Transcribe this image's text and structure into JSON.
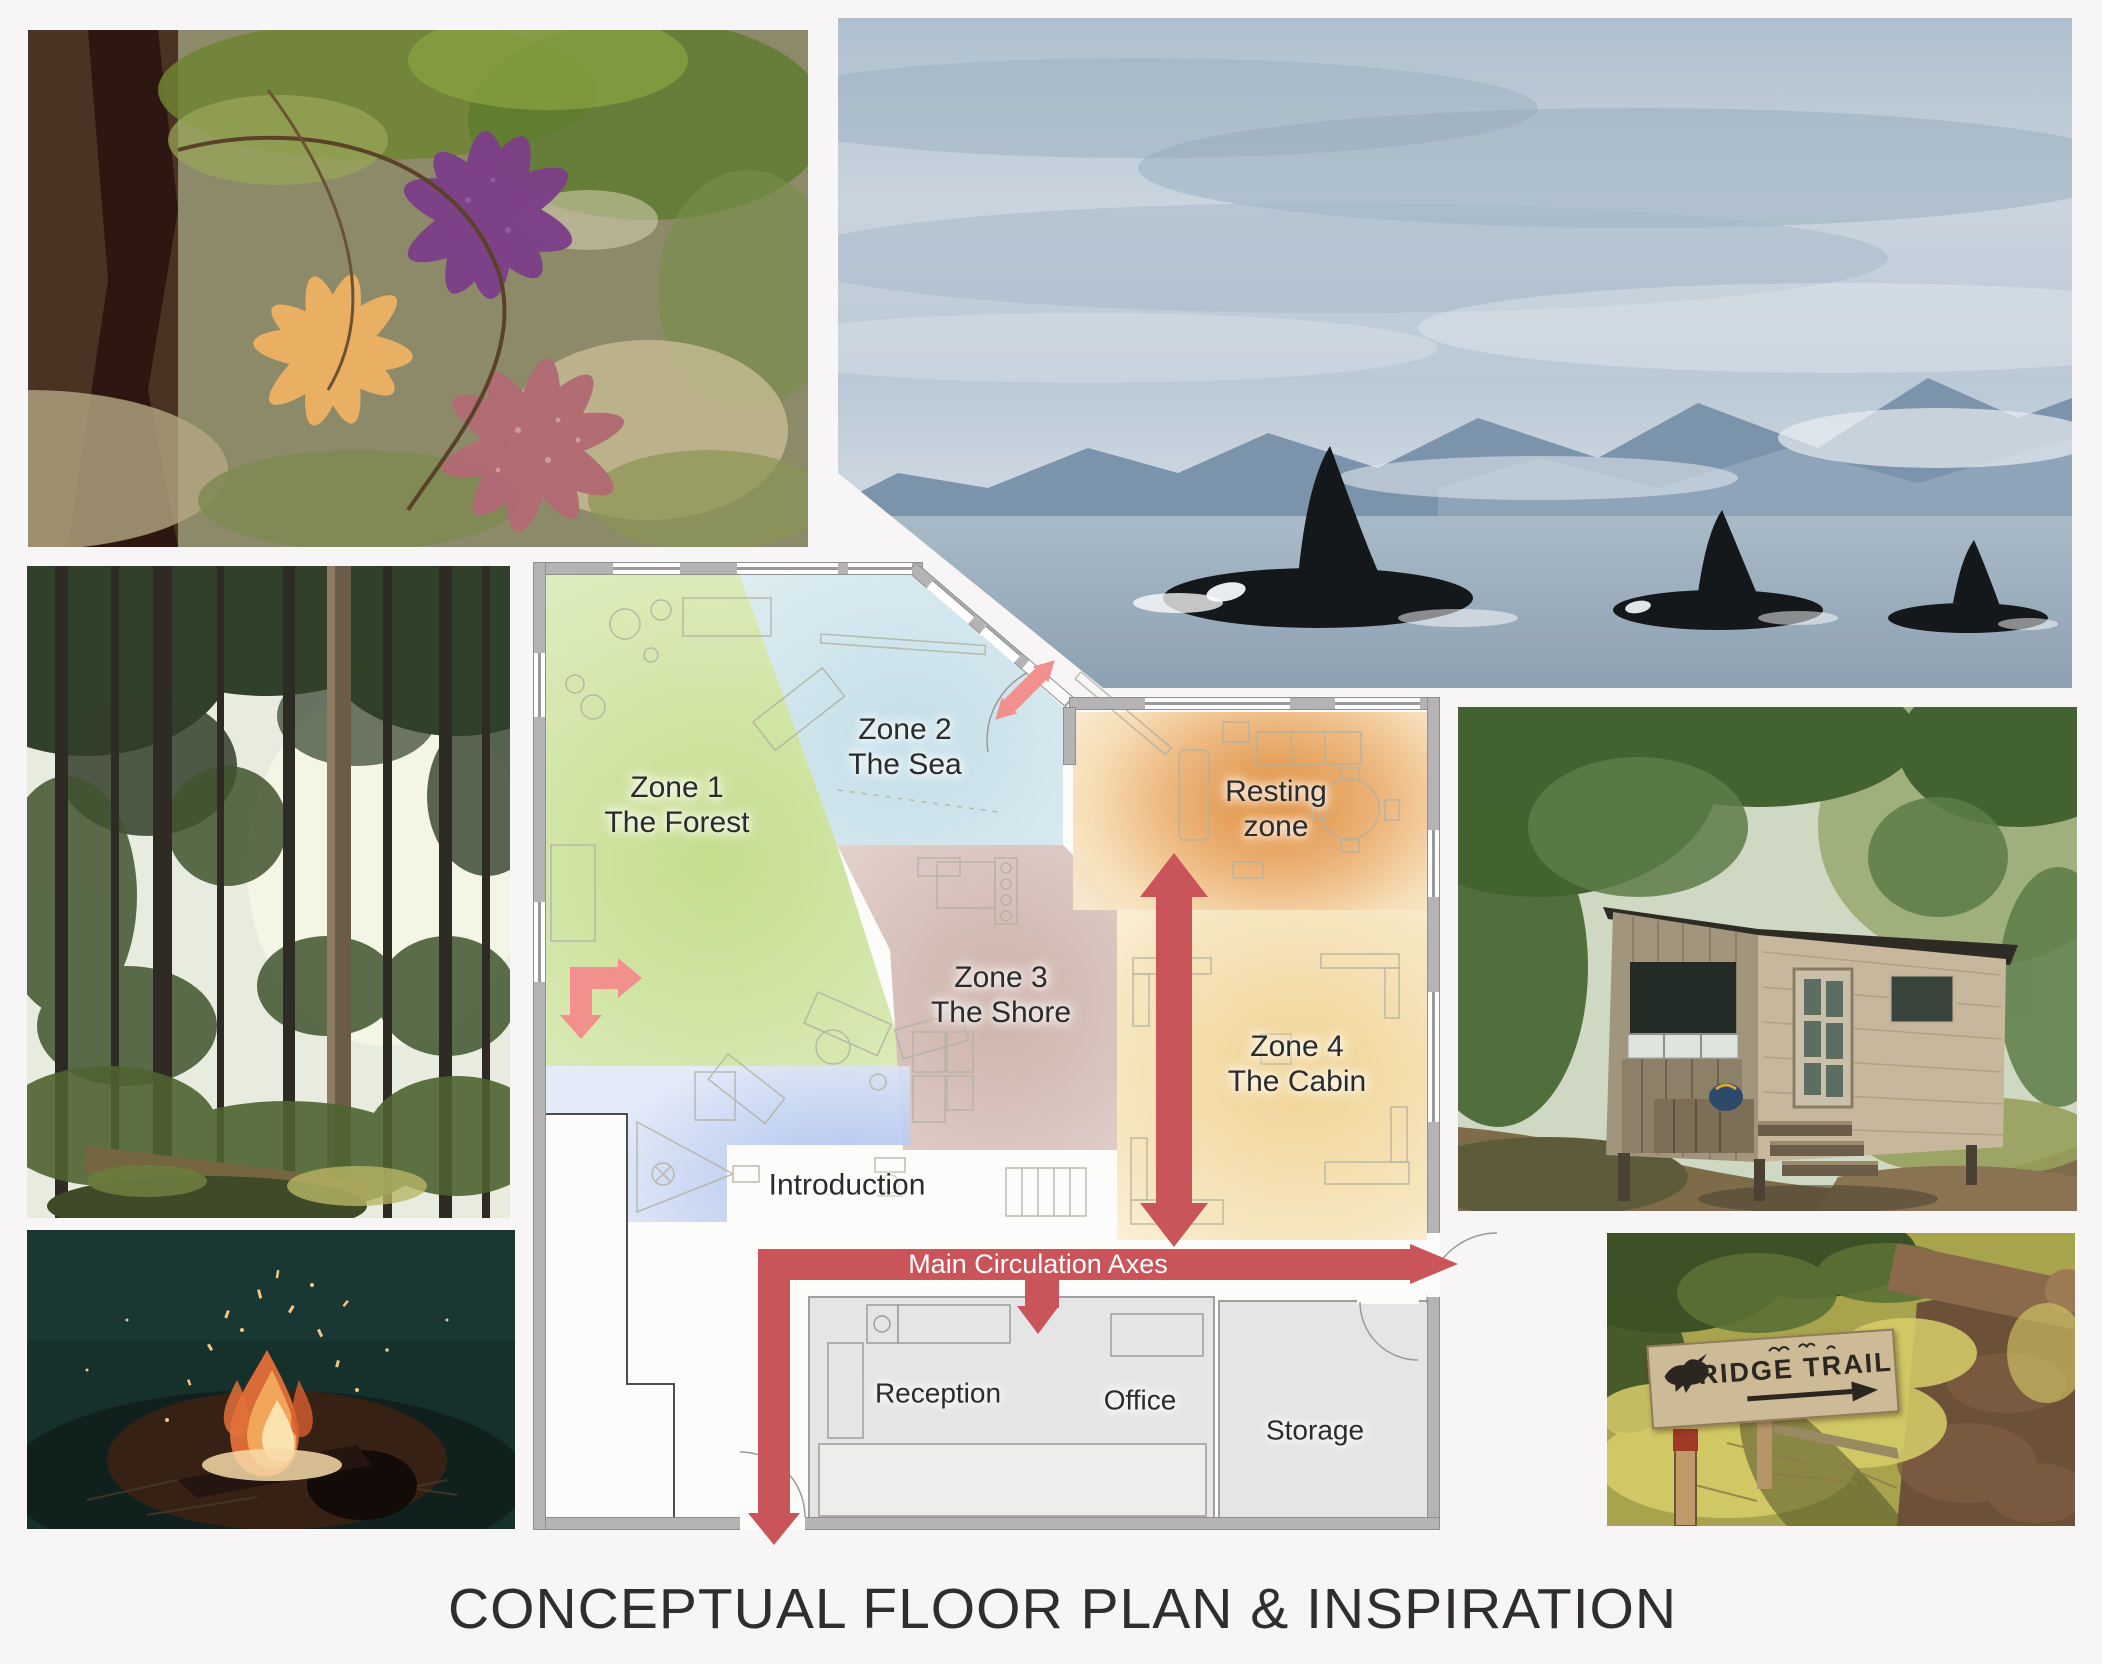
{
  "page": {
    "title": "CONCEPTUAL FLOOR PLAN & INSPIRATION",
    "background_color": "#f7f5f5"
  },
  "floor_plan": {
    "zones": [
      {
        "id": "zone-1",
        "line1": "Zone 1",
        "line2": "The Forest",
        "color": "#c8df93"
      },
      {
        "id": "zone-2",
        "line1": "Zone 2",
        "line2": "The Sea",
        "color": "#c3dde7"
      },
      {
        "id": "zone-3",
        "line1": "Zone 3",
        "line2": "The Shore",
        "color": "#cfb3ab"
      },
      {
        "id": "resting-zone",
        "line1": "Resting",
        "line2": "zone",
        "color": "#dd8630"
      },
      {
        "id": "zone-4",
        "line1": "Zone 4",
        "line2": "The Cabin",
        "color": "#f2d694"
      },
      {
        "id": "introduction",
        "line1": "Introduction",
        "line2": "",
        "color": "#a3bcec"
      }
    ],
    "rooms": [
      {
        "id": "reception",
        "label": "Reception"
      },
      {
        "id": "office",
        "label": "Office"
      },
      {
        "id": "storage",
        "label": "Storage"
      }
    ],
    "circulation": {
      "label": "Main Circulation Axes",
      "primary_color": "#c9545a",
      "secondary_color": "#f2908d"
    }
  },
  "photos": {
    "starfish": {
      "name": "starfish-tidepool-photo"
    },
    "orcas": {
      "name": "orca-pod-photo"
    },
    "forest": {
      "name": "forest-photo"
    },
    "campfire": {
      "name": "campfire-photo"
    },
    "cabin": {
      "name": "wooden-cabin-photo"
    },
    "ridge_trail": {
      "name": "ridge-trail-sign-photo",
      "sign_text": "RIDGE TRAIL"
    }
  }
}
